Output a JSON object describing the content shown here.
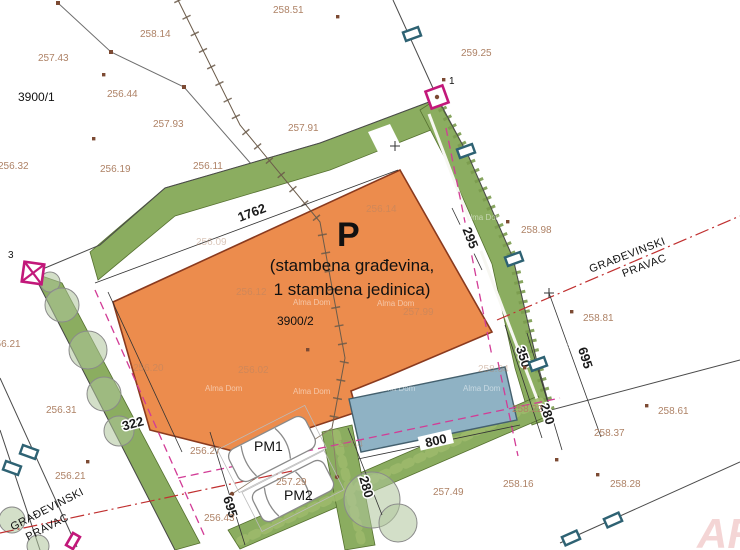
{
  "plan": {
    "parcel_main": "3900/2",
    "parcel_neighbor": "3900/1",
    "point_1": "1",
    "point_3": "3",
    "building_mark": "P",
    "building_desc_1": "(stambena građevina,",
    "building_desc_2": "1 stambena jedinica)",
    "pm1": "PM1",
    "pm2": "PM2",
    "gradevinski": "GRAĐEVINSKI",
    "pravac": "PRAVAC",
    "watermark": "Alma Dom",
    "corner_watermark": "ARH"
  },
  "dimensions": {
    "frontage": "1762",
    "left": "322",
    "left_depth": "695",
    "right_depth": "695",
    "right_350": "350",
    "right_280": "280",
    "bottom_280": "280",
    "pool_800": "800",
    "band_295": "295"
  },
  "spot_heights": [
    "257.43",
    "258.14",
    "258.51",
    "259.25",
    "256.44",
    "257.93",
    "257.91",
    "256.32",
    "256.19",
    "256.11",
    "258.98",
    "258.81",
    "256.21",
    "256.31",
    "256.21",
    "256.27",
    "256.43",
    "257.29",
    "257.49",
    "258.37",
    "258.61",
    "258.16",
    "258.28",
    "258.22"
  ],
  "faint_heights": [
    "256.09",
    "256.12",
    "256.14",
    "257.99",
    "256.20",
    "256.02",
    "257.4",
    "258.04"
  ],
  "colors": {
    "building_fill": "#EC8C4D",
    "building_stroke": "#8A3A1E",
    "green_fill": "#8BAD60",
    "pool_fill": "#8FB2C4",
    "pool_stroke": "#44606E",
    "marker_magenta": "#C2187A",
    "setback_magenta": "#D23C96",
    "building_line_red": "#C03030",
    "spot_height_text": "#AE8266"
  }
}
